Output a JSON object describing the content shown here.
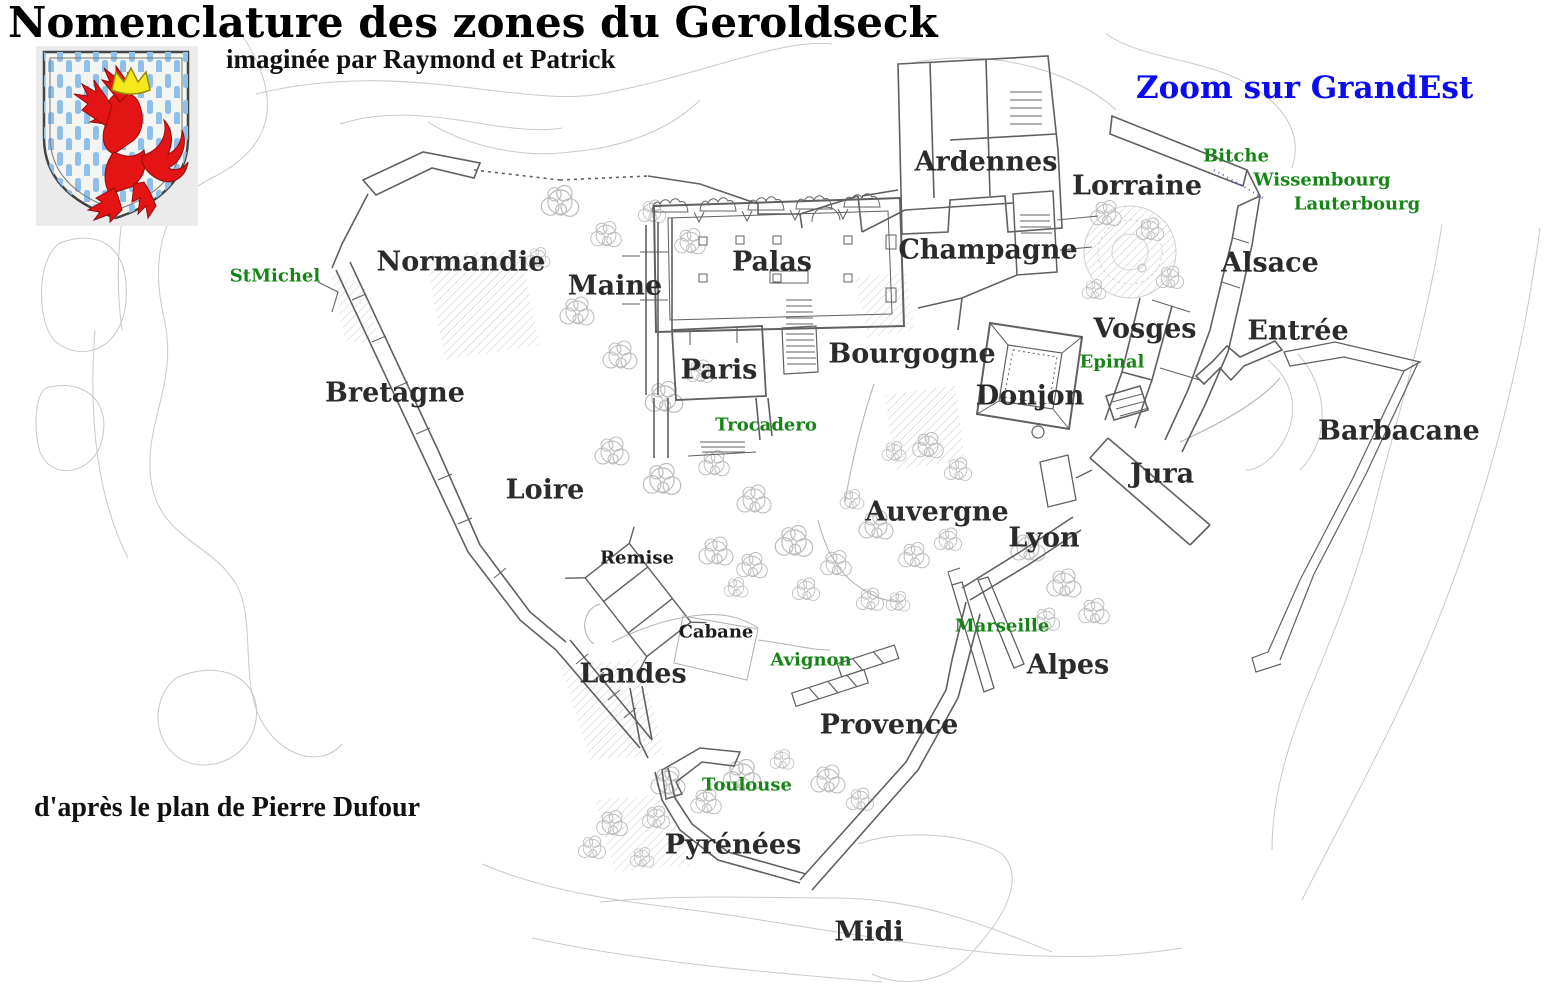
{
  "header": {
    "title": "Nomenclature des zones du Geroldseck",
    "subtitle": "imaginée par Raymond et Patrick"
  },
  "link": {
    "label": "Zoom sur GrandEst"
  },
  "footer": {
    "attribution": "d'après le plan de Pierre Dufour"
  },
  "colors": {
    "title": "#000000",
    "zone_label": "#2b2b2b",
    "poi_label": "#168416",
    "link": "#0b0bf0",
    "crest_lion": "#e41414",
    "crest_stripe": "#8fc0ea",
    "crest_crown": "#f5e91c"
  },
  "map": {
    "zones": [
      {
        "id": "normandie",
        "label": "Normandie",
        "x": 461,
        "y": 262
      },
      {
        "id": "maine",
        "label": "Maine",
        "x": 615,
        "y": 286
      },
      {
        "id": "palas",
        "label": "Palas",
        "x": 772,
        "y": 262
      },
      {
        "id": "ardennes",
        "label": "Ardennes",
        "x": 986,
        "y": 162
      },
      {
        "id": "lorraine",
        "label": "Lorraine",
        "x": 1137,
        "y": 186
      },
      {
        "id": "champagne",
        "label": "Champagne",
        "x": 988,
        "y": 250
      },
      {
        "id": "alsace",
        "label": "Alsace",
        "x": 1270,
        "y": 263
      },
      {
        "id": "vosges",
        "label": "Vosges",
        "x": 1145,
        "y": 329
      },
      {
        "id": "entree",
        "label": "Entrée",
        "x": 1298,
        "y": 331
      },
      {
        "id": "bretagne",
        "label": "Bretagne",
        "x": 395,
        "y": 393
      },
      {
        "id": "paris",
        "label": "Paris",
        "x": 719,
        "y": 370
      },
      {
        "id": "bourgogne",
        "label": "Bourgogne",
        "x": 912,
        "y": 354
      },
      {
        "id": "donjon",
        "label": "Donjon",
        "x": 1030,
        "y": 396
      },
      {
        "id": "barbacane",
        "label": "Barbacane",
        "x": 1399,
        "y": 431
      },
      {
        "id": "loire",
        "label": "Loire",
        "x": 545,
        "y": 490
      },
      {
        "id": "jura",
        "label": "Jura",
        "x": 1162,
        "y": 474
      },
      {
        "id": "auvergne",
        "label": "Auvergne",
        "x": 937,
        "y": 512
      },
      {
        "id": "lyon",
        "label": "Lyon",
        "x": 1044,
        "y": 538
      },
      {
        "id": "remise",
        "label": "Remise",
        "x": 637,
        "y": 558,
        "small": true
      },
      {
        "id": "cabane",
        "label": "Cabane",
        "x": 716,
        "y": 632,
        "small": true
      },
      {
        "id": "landes",
        "label": "Landes",
        "x": 633,
        "y": 674
      },
      {
        "id": "alpes",
        "label": "Alpes",
        "x": 1068,
        "y": 665
      },
      {
        "id": "provence",
        "label": "Provence",
        "x": 889,
        "y": 725
      },
      {
        "id": "pyrenees",
        "label": "Pyrénées",
        "x": 733,
        "y": 845
      },
      {
        "id": "midi",
        "label": "Midi",
        "x": 869,
        "y": 932
      }
    ],
    "pois": [
      {
        "id": "stmichel",
        "label": "StMichel",
        "x": 275,
        "y": 276
      },
      {
        "id": "bitche",
        "label": "Bitche",
        "x": 1236,
        "y": 156
      },
      {
        "id": "wissembourg",
        "label": "Wissembourg",
        "x": 1322,
        "y": 180
      },
      {
        "id": "lauterbourg",
        "label": "Lauterbourg",
        "x": 1357,
        "y": 204
      },
      {
        "id": "epinal",
        "label": "Epinal",
        "x": 1112,
        "y": 362
      },
      {
        "id": "trocadero",
        "label": "Trocadero",
        "x": 766,
        "y": 425
      },
      {
        "id": "marseille",
        "label": "Marseille",
        "x": 1002,
        "y": 626
      },
      {
        "id": "avignon",
        "label": "Avignon",
        "x": 811,
        "y": 660
      },
      {
        "id": "toulouse",
        "label": "Toulouse",
        "x": 747,
        "y": 785
      }
    ]
  }
}
